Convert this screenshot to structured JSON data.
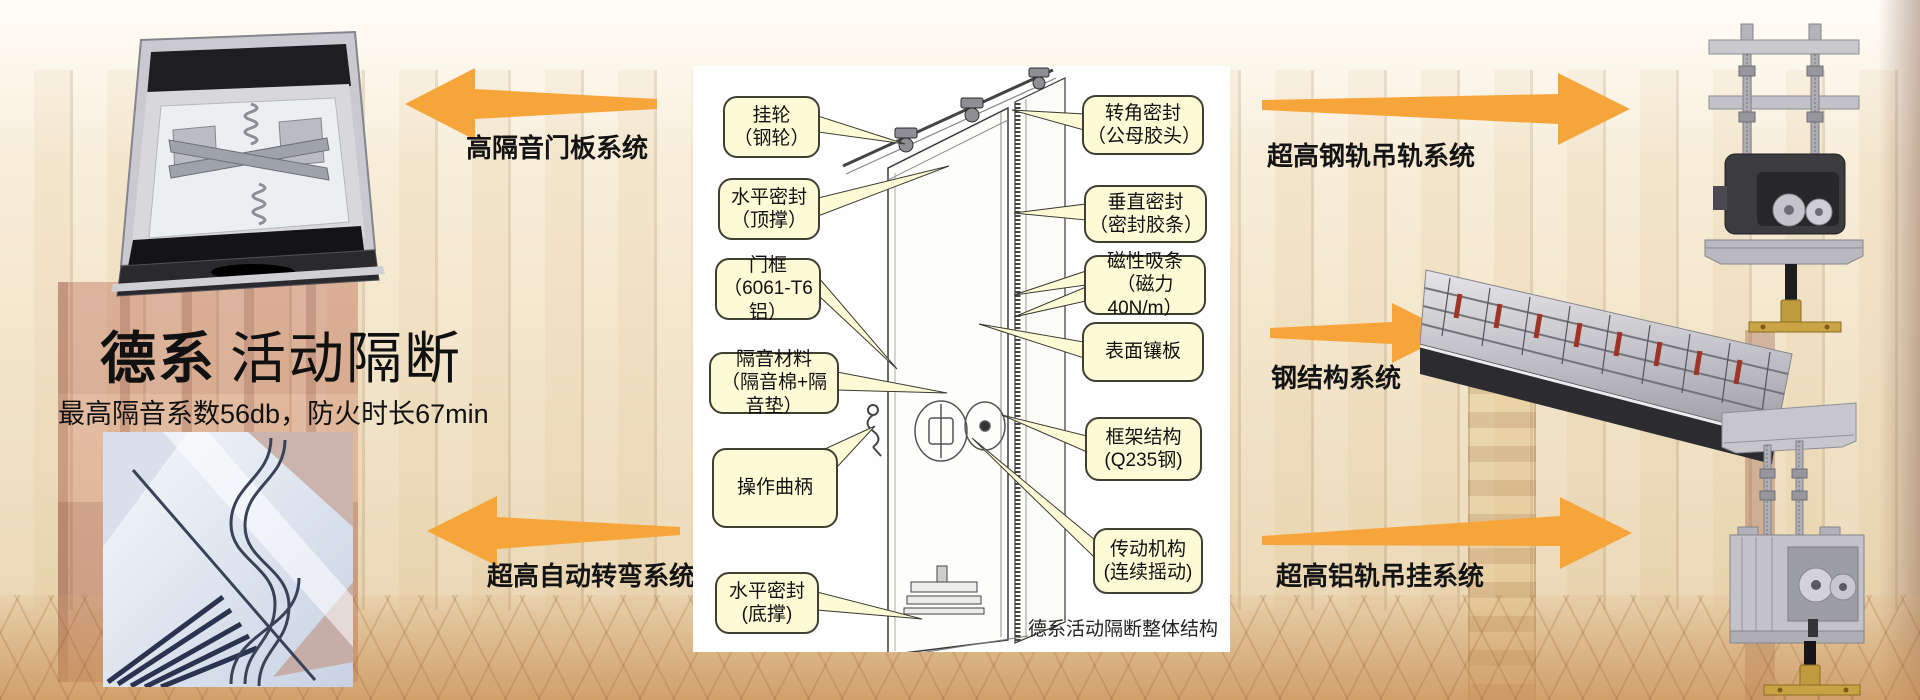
{
  "hero": {
    "title_bold": "德系",
    "title_rest": "活动隔断",
    "subtitle": "最高隔音系数56db，防火时长67min"
  },
  "arrows": {
    "left_top_label": "高隔音门板系统",
    "left_bottom_label": "超高自动转弯系统",
    "right_top_label": "超高钢轨吊轨系统",
    "right_middle_label": "钢结构系统",
    "right_bottom_label": "超高铝轨吊挂系统"
  },
  "diagram": {
    "caption": "德系活动隔断整体结构",
    "callouts_left": [
      {
        "title": "挂轮",
        "sub": "（钢轮）"
      },
      {
        "title": "水平密封",
        "sub": "（顶撑）"
      },
      {
        "title": "门框",
        "sub": "（6061-T6铝）"
      },
      {
        "title": "隔音材料",
        "sub": "（隔音棉+隔音垫）"
      },
      {
        "title": "操作曲柄",
        "sub": ""
      },
      {
        "title": "水平密封",
        "sub": "(底撑)"
      }
    ],
    "callouts_right": [
      {
        "title": "转角密封",
        "sub": "（公母胶头）"
      },
      {
        "title": "垂直密封",
        "sub": "（密封胶条）"
      },
      {
        "title": "磁性吸条",
        "sub": "（磁力40N/m）"
      },
      {
        "title": "表面镶板",
        "sub": ""
      },
      {
        "title": "框架结构",
        "sub": "(Q235钢)"
      },
      {
        "title": "传动机构",
        "sub": "(连续摇动)"
      }
    ]
  },
  "colors": {
    "accent_orange": "#F6A53B",
    "callout_bg": "#FCFBD6",
    "callout_border": "#403F33"
  }
}
